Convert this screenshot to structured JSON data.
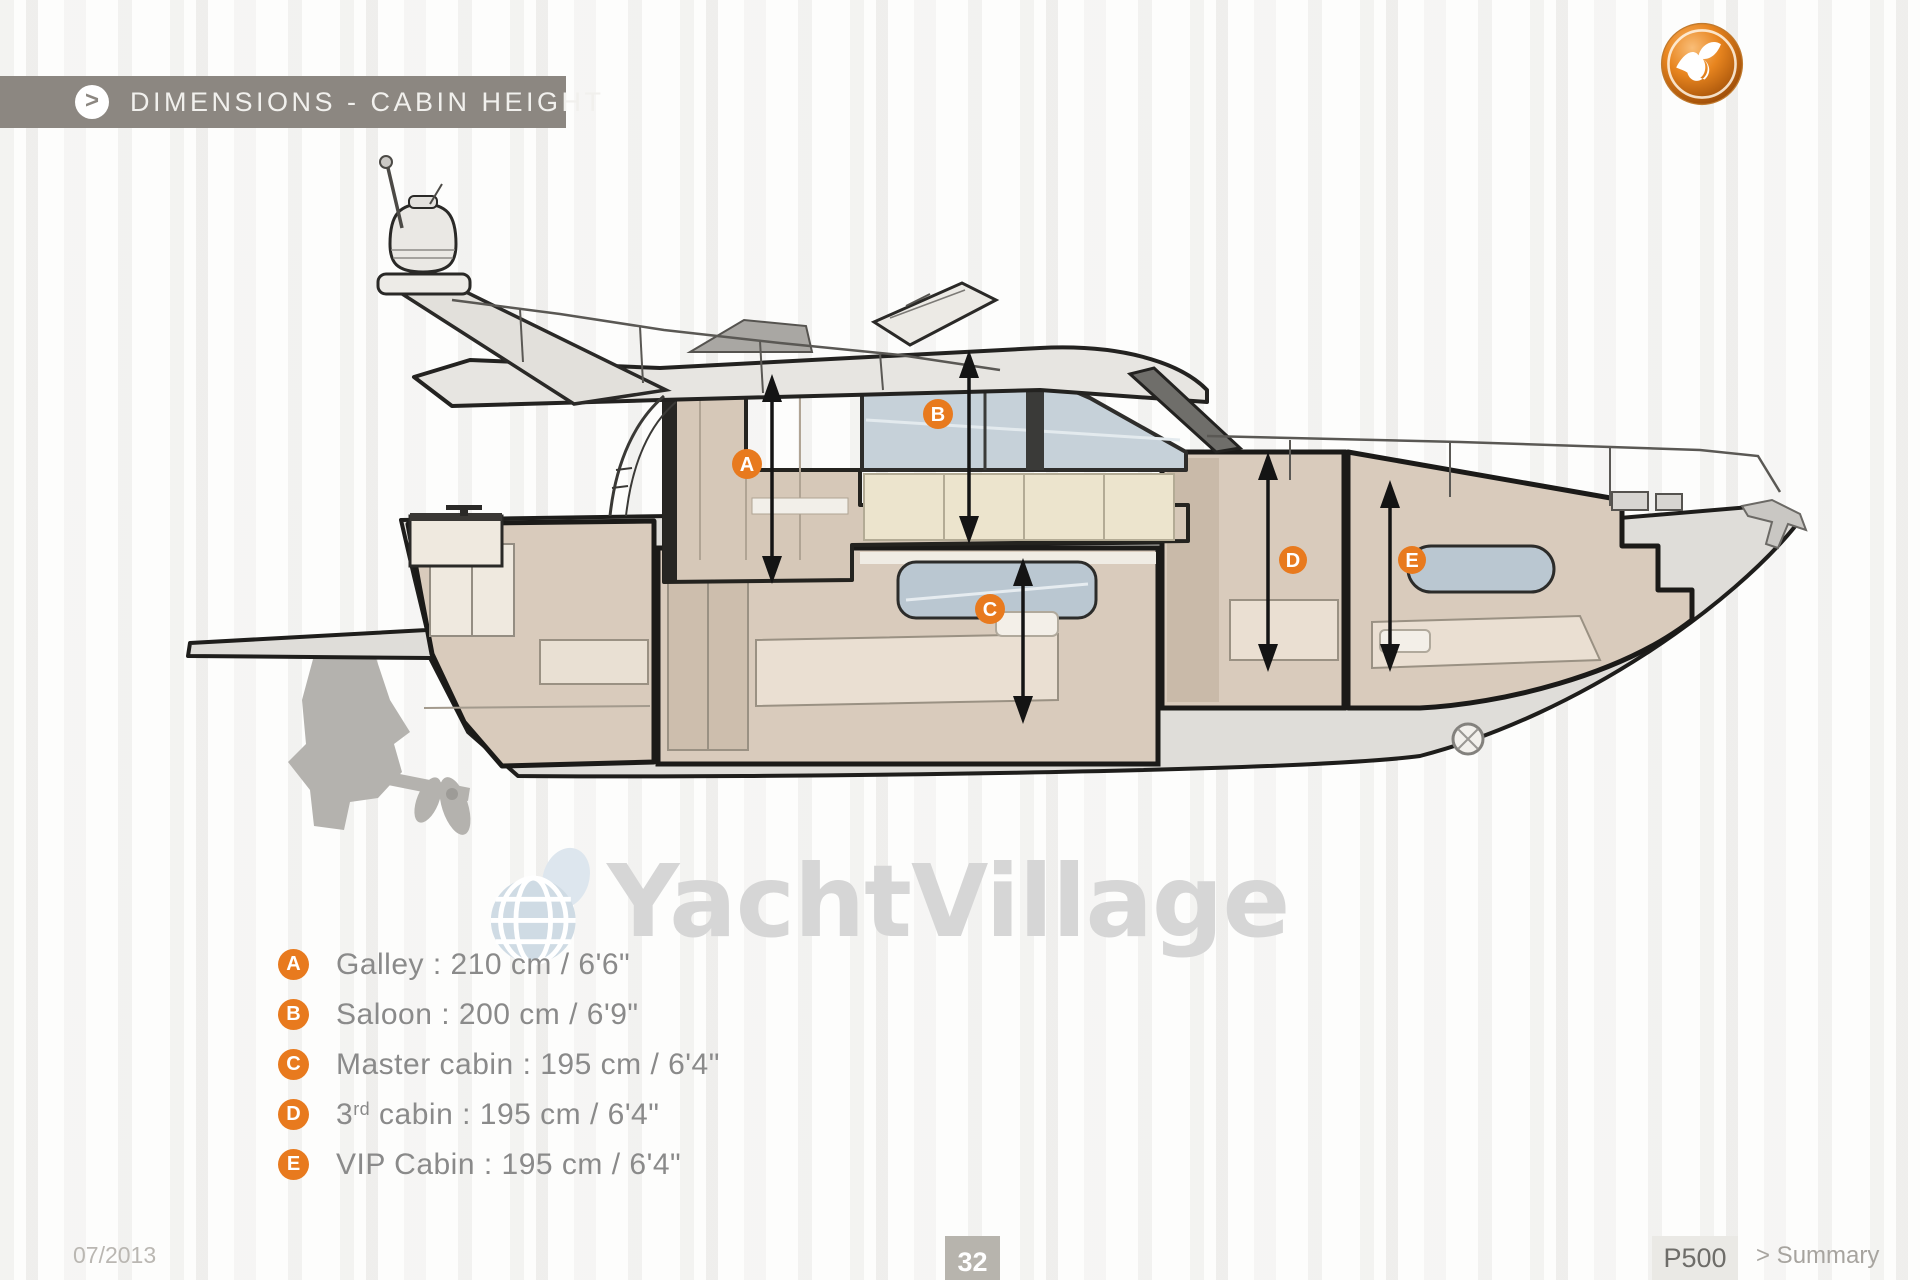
{
  "header": {
    "title": "DIMENSIONS - CABIN HEIGHT",
    "chevron_icon": ">"
  },
  "branding": {
    "logo_icon": "prestige-bird-logo"
  },
  "watermark": {
    "text": "YachtVillage",
    "globe_icon": "globe"
  },
  "diagram": {
    "type": "yacht-side-cross-section",
    "markers": [
      {
        "letter": "A",
        "area": "Galley",
        "height_cm": 210,
        "height_imperial": "6'6\""
      },
      {
        "letter": "B",
        "area": "Saloon",
        "height_cm": 200,
        "height_imperial": "6'9\""
      },
      {
        "letter": "C",
        "area": "Master cabin",
        "height_cm": 195,
        "height_imperial": "6'4\""
      },
      {
        "letter": "D",
        "area": "3rd cabin",
        "height_cm": 195,
        "height_imperial": "6'4\""
      },
      {
        "letter": "E",
        "area": "VIP Cabin",
        "height_cm": 195,
        "height_imperial": "6'4\""
      }
    ]
  },
  "legend": {
    "items": [
      {
        "letter": "A",
        "pre": "Galley : 210 cm / 6'6\"",
        "sup": "",
        "post": ""
      },
      {
        "letter": "B",
        "pre": "Saloon : 200 cm / 6'9\"",
        "sup": "",
        "post": ""
      },
      {
        "letter": "C",
        "pre": "Master cabin : 195 cm / 6'4\"",
        "sup": "",
        "post": ""
      },
      {
        "letter": "D",
        "pre": "3",
        "sup": "rd",
        "post": " cabin : 195 cm / 6'4\""
      },
      {
        "letter": "E",
        "pre": "VIP Cabin : 195 cm / 6'4\"",
        "sup": "",
        "post": ""
      }
    ]
  },
  "footer": {
    "date": "07/2013",
    "page_number": "32",
    "model": "P500",
    "summary": "> Summary"
  },
  "colors": {
    "accent_orange": "#e87a1e",
    "banner_gray": "#8c8781",
    "hull_gray": "#dfddd9",
    "interior_beige": "#d9cbbc",
    "glass_blue": "#bac7d1",
    "watermark_gray": "#d6d6d6"
  }
}
